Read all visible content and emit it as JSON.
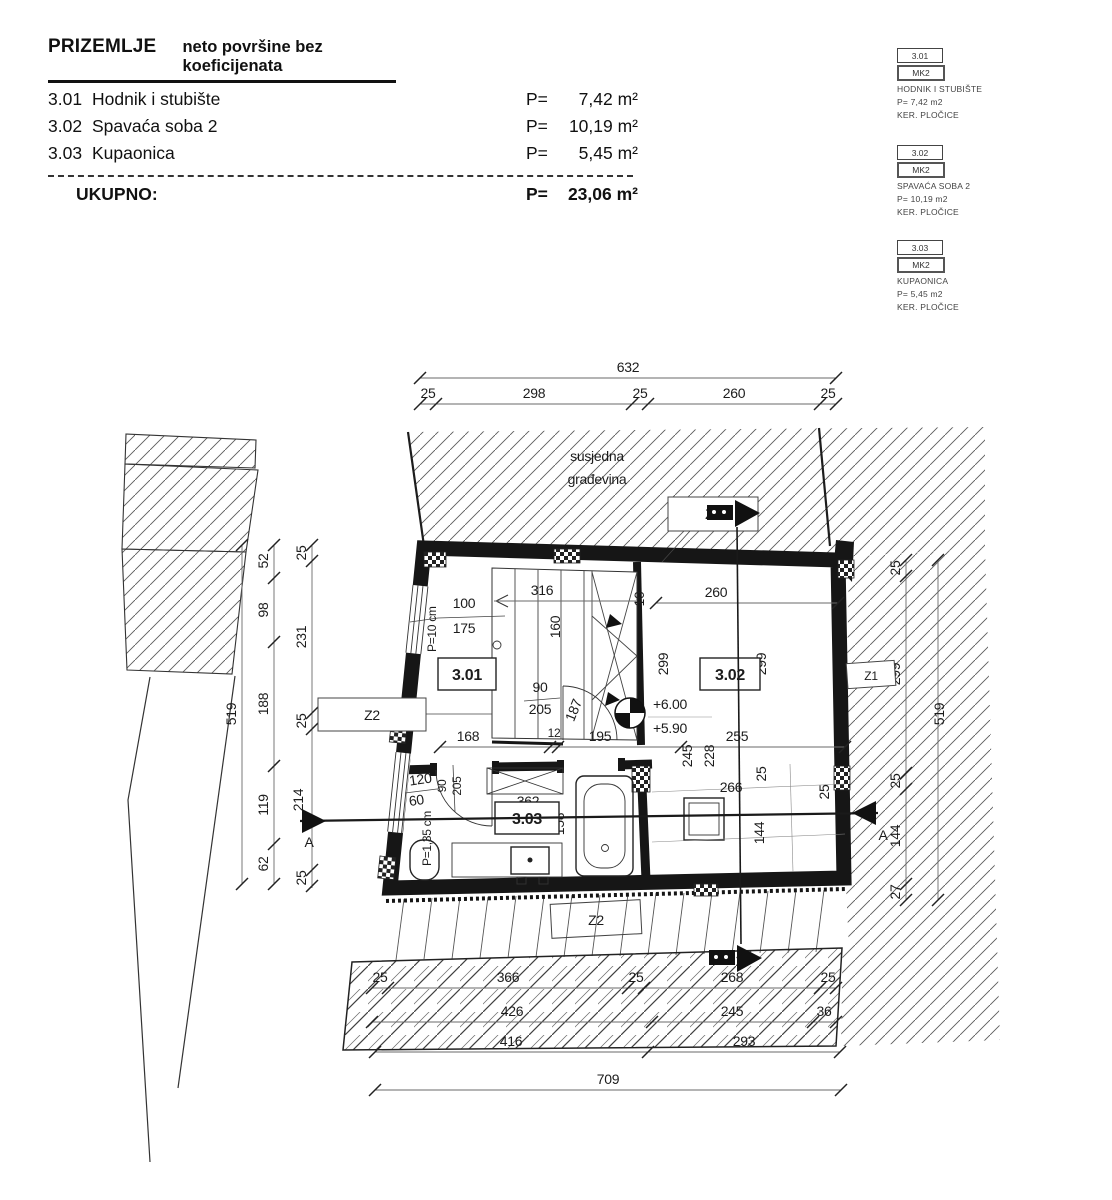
{
  "header": {
    "title": "PRIZEMLJE",
    "subtitle": "neto površine bez koeficijenata",
    "rows": [
      {
        "code": "3.01",
        "name": "Hodnik i stubište",
        "p": "P=",
        "area": "7,42 m²"
      },
      {
        "code": "3.02",
        "name": "Spavaća soba 2",
        "p": "P=",
        "area": "10,19 m²"
      },
      {
        "code": "3.03",
        "name": "Kupaonica",
        "p": "P=",
        "area": "5,45 m²"
      }
    ],
    "total_label": "UKUPNO:",
    "total_p": "P=",
    "total_area": "23,06 m²"
  },
  "legend": [
    {
      "code": "3.01",
      "tag": "MK2",
      "name": "HODNIK I STUBIŠTE",
      "area": "P= 7,42 m2",
      "finish": "KER. PLOČICE"
    },
    {
      "code": "3.02",
      "tag": "MK2",
      "name": "SPAVAĆA SOBA 2",
      "area": "P= 10,19 m2",
      "finish": "KER. PLOČICE"
    },
    {
      "code": "3.03",
      "tag": "MK2",
      "name": "KUPAONICA",
      "area": "P= 5,45 m2",
      "finish": "KER. PLOČICE"
    }
  ],
  "plan": {
    "neighbor_line1": "susjedna",
    "neighbor_line2": "građevina",
    "room_301": "3.01",
    "room_302": "3.02",
    "room_303": "3.03",
    "z1": "Z1",
    "z2": "Z2",
    "section": "A",
    "level_top": "+6.00",
    "level_bottom": "+5.90",
    "dims": {
      "top_total": "632",
      "top_chain": [
        "25",
        "298",
        "25",
        "260",
        "25"
      ],
      "left_total": "519",
      "left_outer": [
        "52",
        "98",
        "188",
        "119",
        "62"
      ],
      "left_inner": [
        "25",
        "231",
        "25",
        "214",
        "25"
      ],
      "right_total": "519",
      "right_inner": [
        "25",
        "299",
        "25",
        "144",
        "27"
      ],
      "stair_run": "316",
      "stair_width": "160",
      "stair_wall": "10",
      "win1_w": "100",
      "win1_h": "175",
      "win1_parapet": "P=10 cm",
      "r302_w": "260",
      "r302_d_left": "299",
      "r302_d_right": "299",
      "door1_w": "90",
      "door1_h": "205",
      "door1_arc": "187",
      "mid_168": "168",
      "mid_12": "12",
      "mid_195": "195",
      "mid_255": "255",
      "v_245": "245",
      "v_228": "228",
      "v_25a": "25",
      "v_25b": "25",
      "terrace_w": "266",
      "terrace_d": "144",
      "win2_w": "120",
      "win2_h": "60",
      "win2_parapet": "P=1,35 cm",
      "door2_w": "90",
      "door2_h": "205",
      "shaft_w": "362",
      "bath_d": "158",
      "row1": [
        "25",
        "366",
        "25",
        "268",
        "25"
      ],
      "row2": [
        "426",
        "245",
        "36"
      ],
      "row3": [
        "416",
        "293"
      ],
      "bottom_total": "709"
    }
  }
}
